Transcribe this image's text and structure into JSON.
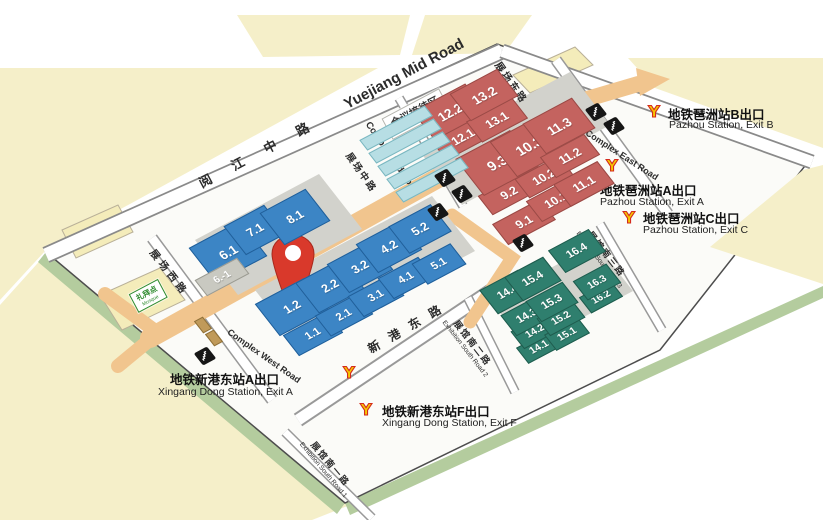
{
  "title": "Canton Fair Complex (Pazhou) area map",
  "colors": {
    "hall_blue": "#3c85c5",
    "hall_red": "#c4635f",
    "hall_green": "#2f7f6e",
    "hall_gray": "#c9c9c1",
    "promenade_orange": "#f1c58e",
    "ground_yellow": "#f5efc9",
    "edge_green": "#b4cc9e",
    "pin_red": "#d9392b",
    "metro_logo_yellow": "#f6c700",
    "metro_logo_red": "#d42a1d"
  },
  "roads": {
    "yuejiang": {
      "zh": "阅 江 中 路",
      "en": "Yuejiang  Mid  Road"
    },
    "complex_west": {
      "zh": "展场西路",
      "en": "Complex West Road"
    },
    "complex_mid": {
      "zh": "展场中路",
      "en": "Complex Mid Road"
    },
    "complex_east": {
      "zh": "展场东路",
      "en": "Complex East Road"
    },
    "xingang_east": {
      "zh": "新 港 东 路"
    },
    "exhibition_south_1": {
      "zh": "展馆南一路",
      "en": "Exhibition South Road 1"
    },
    "exhibition_south_2": {
      "zh": "展馆南二路",
      "en": "Exhibition South Road 2"
    },
    "exhibition_south_3": {
      "zh": "展馆南三路",
      "en": "Exhibition South Road 3"
    }
  },
  "halls": {
    "area_a_blue": [
      "1.1",
      "1.2",
      "2.1",
      "2.2",
      "3.1",
      "3.2",
      "4.1",
      "4.2",
      "5.1",
      "5.2",
      "6.1",
      "7.1",
      "8.1"
    ],
    "annex_gray": [
      "6.-1"
    ],
    "area_b_red": [
      "9.1",
      "9.2",
      "9.3",
      "10.1",
      "10.2",
      "10.3",
      "11.1",
      "11.2",
      "11.3",
      "12.1",
      "12.2",
      "13.1",
      "13.2"
    ],
    "area_c_green": [
      "14.1",
      "14.2",
      "14.3",
      "14.4",
      "15.1",
      "15.2",
      "15.3",
      "15.4",
      "16.2",
      "16.3",
      "16.4"
    ]
  },
  "pois": {
    "conference": {
      "zh": "会议接待区",
      "en": "Conference Reception Area"
    },
    "mosque": {
      "zh": "礼拜点",
      "en": "Mosque"
    }
  },
  "metro_exits": [
    {
      "id": "pazhou_b",
      "zh": "地铁琶洲站B出口",
      "en": "Pazhou Station, Exit B"
    },
    {
      "id": "pazhou_a",
      "zh": "地铁琶洲站A出口",
      "en": "Pazhou Station, Exit A"
    },
    {
      "id": "pazhou_c",
      "zh": "地铁琶洲站C出口",
      "en": "Pazhou Station, Exit C"
    },
    {
      "id": "xingang_a",
      "zh": "地铁新港东站A出口",
      "en": "Xingang Dong Station, Exit A"
    },
    {
      "id": "xingang_f",
      "zh": "地铁新港东站F出口",
      "en": "Xingang Dong Station, Exit F"
    }
  ],
  "marker": {
    "name": "location-pin"
  },
  "icons": {
    "footbridge": "footbridge-stairs-icon",
    "metro": "guangzhou-metro-logo-icon"
  }
}
